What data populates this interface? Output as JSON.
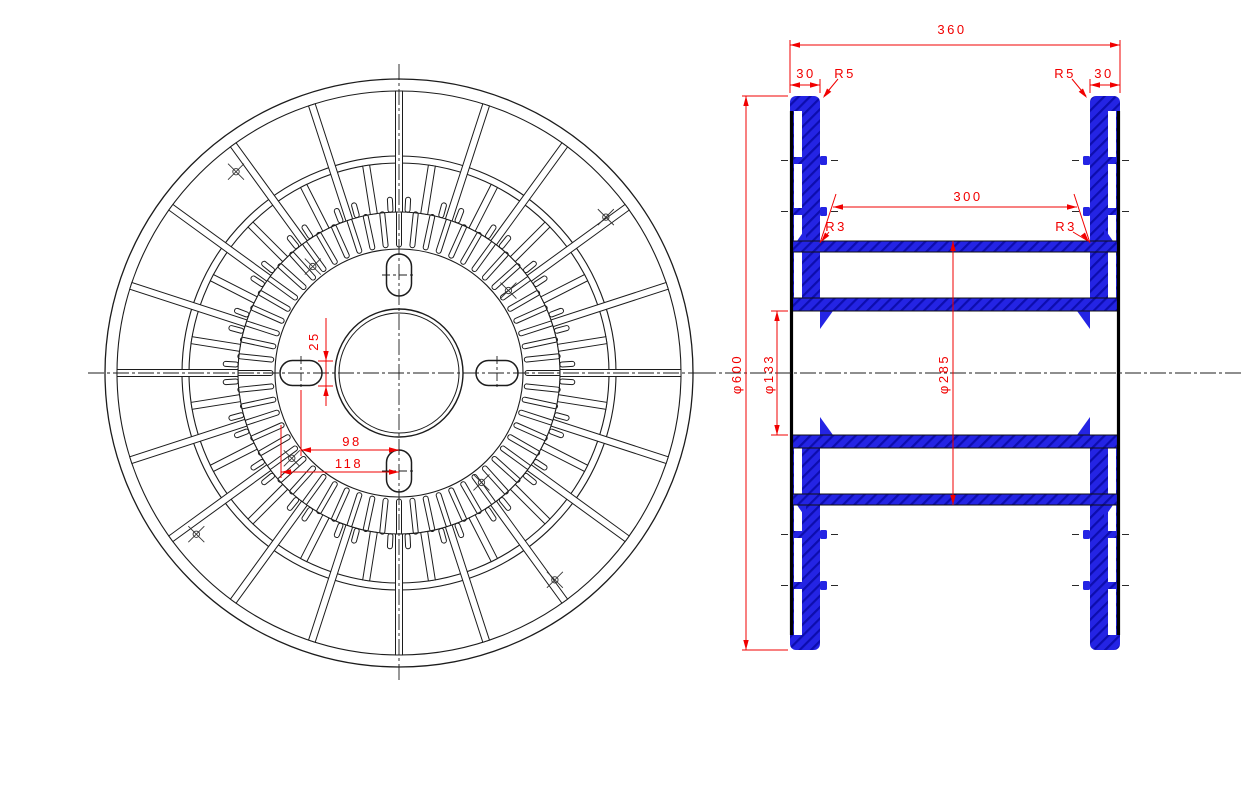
{
  "title": "Cable reel technical drawing (two views)",
  "canvas": {
    "width": 1247,
    "height": 790
  },
  "colors": {
    "dimension_red": "#f10000",
    "section_blue": "#2424e4",
    "hatch_blue": "#0d0dae",
    "line_black": "#1c1c1c"
  },
  "front_view": {
    "dimensions": {
      "slot_width": "25",
      "slot_center_offset": "98",
      "slot_outer_offset": "118"
    },
    "geometry": {
      "cx": 399,
      "cy": 373,
      "r_outer": 294,
      "r_rim": 282,
      "r_mid_outer": 217,
      "r_mid_inner": 210,
      "r_teeth_outer": 161,
      "r_teeth_inner": 126,
      "r_stub_tip": 176,
      "r_disc": 124,
      "r_bore": 64,
      "r_bore_inner": 60,
      "spoke_count": 20,
      "spoke_width": 7,
      "inner_spoke_count": 20,
      "tooth_count": 60,
      "tooth_width": 5,
      "stub_width": 5,
      "slot_radius": 98,
      "slot_length": 42,
      "slot_width_px": 25,
      "marker_angles": [
        129,
        37,
        218.5,
        307
      ],
      "marker_r_inner": 137,
      "marker_r_outer": 259
    }
  },
  "side_view": {
    "dimensions": {
      "overall_width": "360",
      "flange_wall_left": "30",
      "flange_wall_right": "30",
      "corner_radius_left": "R5",
      "corner_radius_right": "R5",
      "barrel_length": "300",
      "fillet_left": "R3",
      "fillet_right": "R3",
      "flange_diameter": "φ600",
      "bore_diameter": "φ133",
      "barrel_diameter": "φ285"
    },
    "geometry": {
      "center_y": 373,
      "flange_top": 96,
      "flange_bottom": 650,
      "left_face": 790,
      "left_inner": 820,
      "right_inner": 1090,
      "right_face": 1120,
      "wall_thickness": 14,
      "web_thickness": 12,
      "cell_rows": [
        [
          111,
          157
        ],
        [
          164,
          208
        ],
        [
          215,
          241
        ],
        [
          252,
          298
        ],
        [
          448,
          494
        ],
        [
          505,
          531
        ],
        [
          538,
          582
        ],
        [
          589,
          635
        ]
      ],
      "rib_centers": [
        160.5,
        211.5,
        534.5,
        585.5
      ],
      "barrel_top": 241,
      "barrel_wall": 11,
      "barrel_bottom": 505,
      "hub_top": 298,
      "hub_wall": 13,
      "bore_top": 311,
      "bore_bottom": 435
    }
  }
}
